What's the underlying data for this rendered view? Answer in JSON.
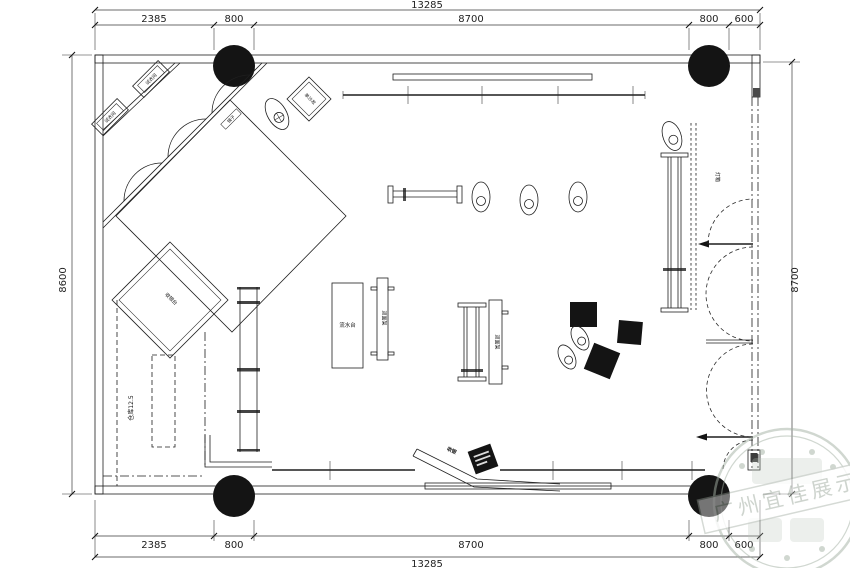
{
  "plan": {
    "dimensions": {
      "top": {
        "overall": "13285",
        "segments": [
          "2385",
          "800",
          "8700",
          "800",
          "600"
        ]
      },
      "bottom": {
        "overall": "13285",
        "segments": [
          "2385",
          "800",
          "8700",
          "800",
          "600"
        ]
      },
      "left": "8600",
      "right": "8700"
    },
    "rooms": {
      "fitting_1": "试衣间",
      "fitting_2": "试衣间",
      "sofa": "单沙发",
      "mirror": "镜子",
      "cashier_room": "收银台",
      "storage": "仓库12.5"
    },
    "fixtures": {
      "display_table": "流水台",
      "rack_label_1": "双面架",
      "rack_label_2": "双面架",
      "lightbox": "灯箱",
      "desk_label": "收银"
    },
    "watermark": {
      "text": "广州宜佳展示"
    },
    "colors": {
      "line": "#1f1f1f",
      "column": "#141414",
      "stamp": "#a3b0a3"
    }
  }
}
